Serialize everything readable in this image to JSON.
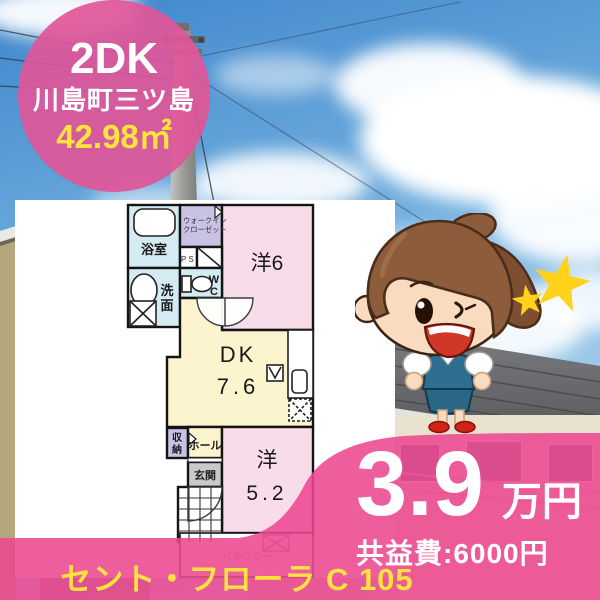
{
  "badge": {
    "layout_type": "2DK",
    "location": "川島町三ツ島",
    "area": "42.98㎡"
  },
  "price": {
    "rent_value": "3.9",
    "rent_unit": "万円",
    "common_fee": "共益費:6000円"
  },
  "footer": {
    "property_name": "セント・フローラ C 105"
  },
  "floorplan": {
    "bath": "浴室",
    "walkin_1": "ウォークイン",
    "walkin_2": "クローゼット",
    "ps": "PS",
    "wash_1": "洗",
    "wash_2": "面",
    "wc_1": "W",
    "wc_2": "C",
    "western6": "洋6",
    "dk": "DK",
    "dk_size": "7.6",
    "storage_1": "収",
    "storage_2": "納",
    "hall": "ホール",
    "entrance": "玄関",
    "western5_label": "洋",
    "western5_size": "5.2",
    "balcony": "バルコニー"
  },
  "decorations": {
    "star_count": 2
  },
  "colors": {
    "overlay_pink": "#ec4890",
    "badge_pink": "#e0568f",
    "accent_yellow": "#ffe33e",
    "room_pink": "#f9dcea",
    "room_yellow": "#fbf4cf",
    "room_blue": "#d4ebf4",
    "room_purple": "#c9c2e5",
    "entrance_gray": "#c9c9c9",
    "sky_blue": "#4a8fd4"
  }
}
